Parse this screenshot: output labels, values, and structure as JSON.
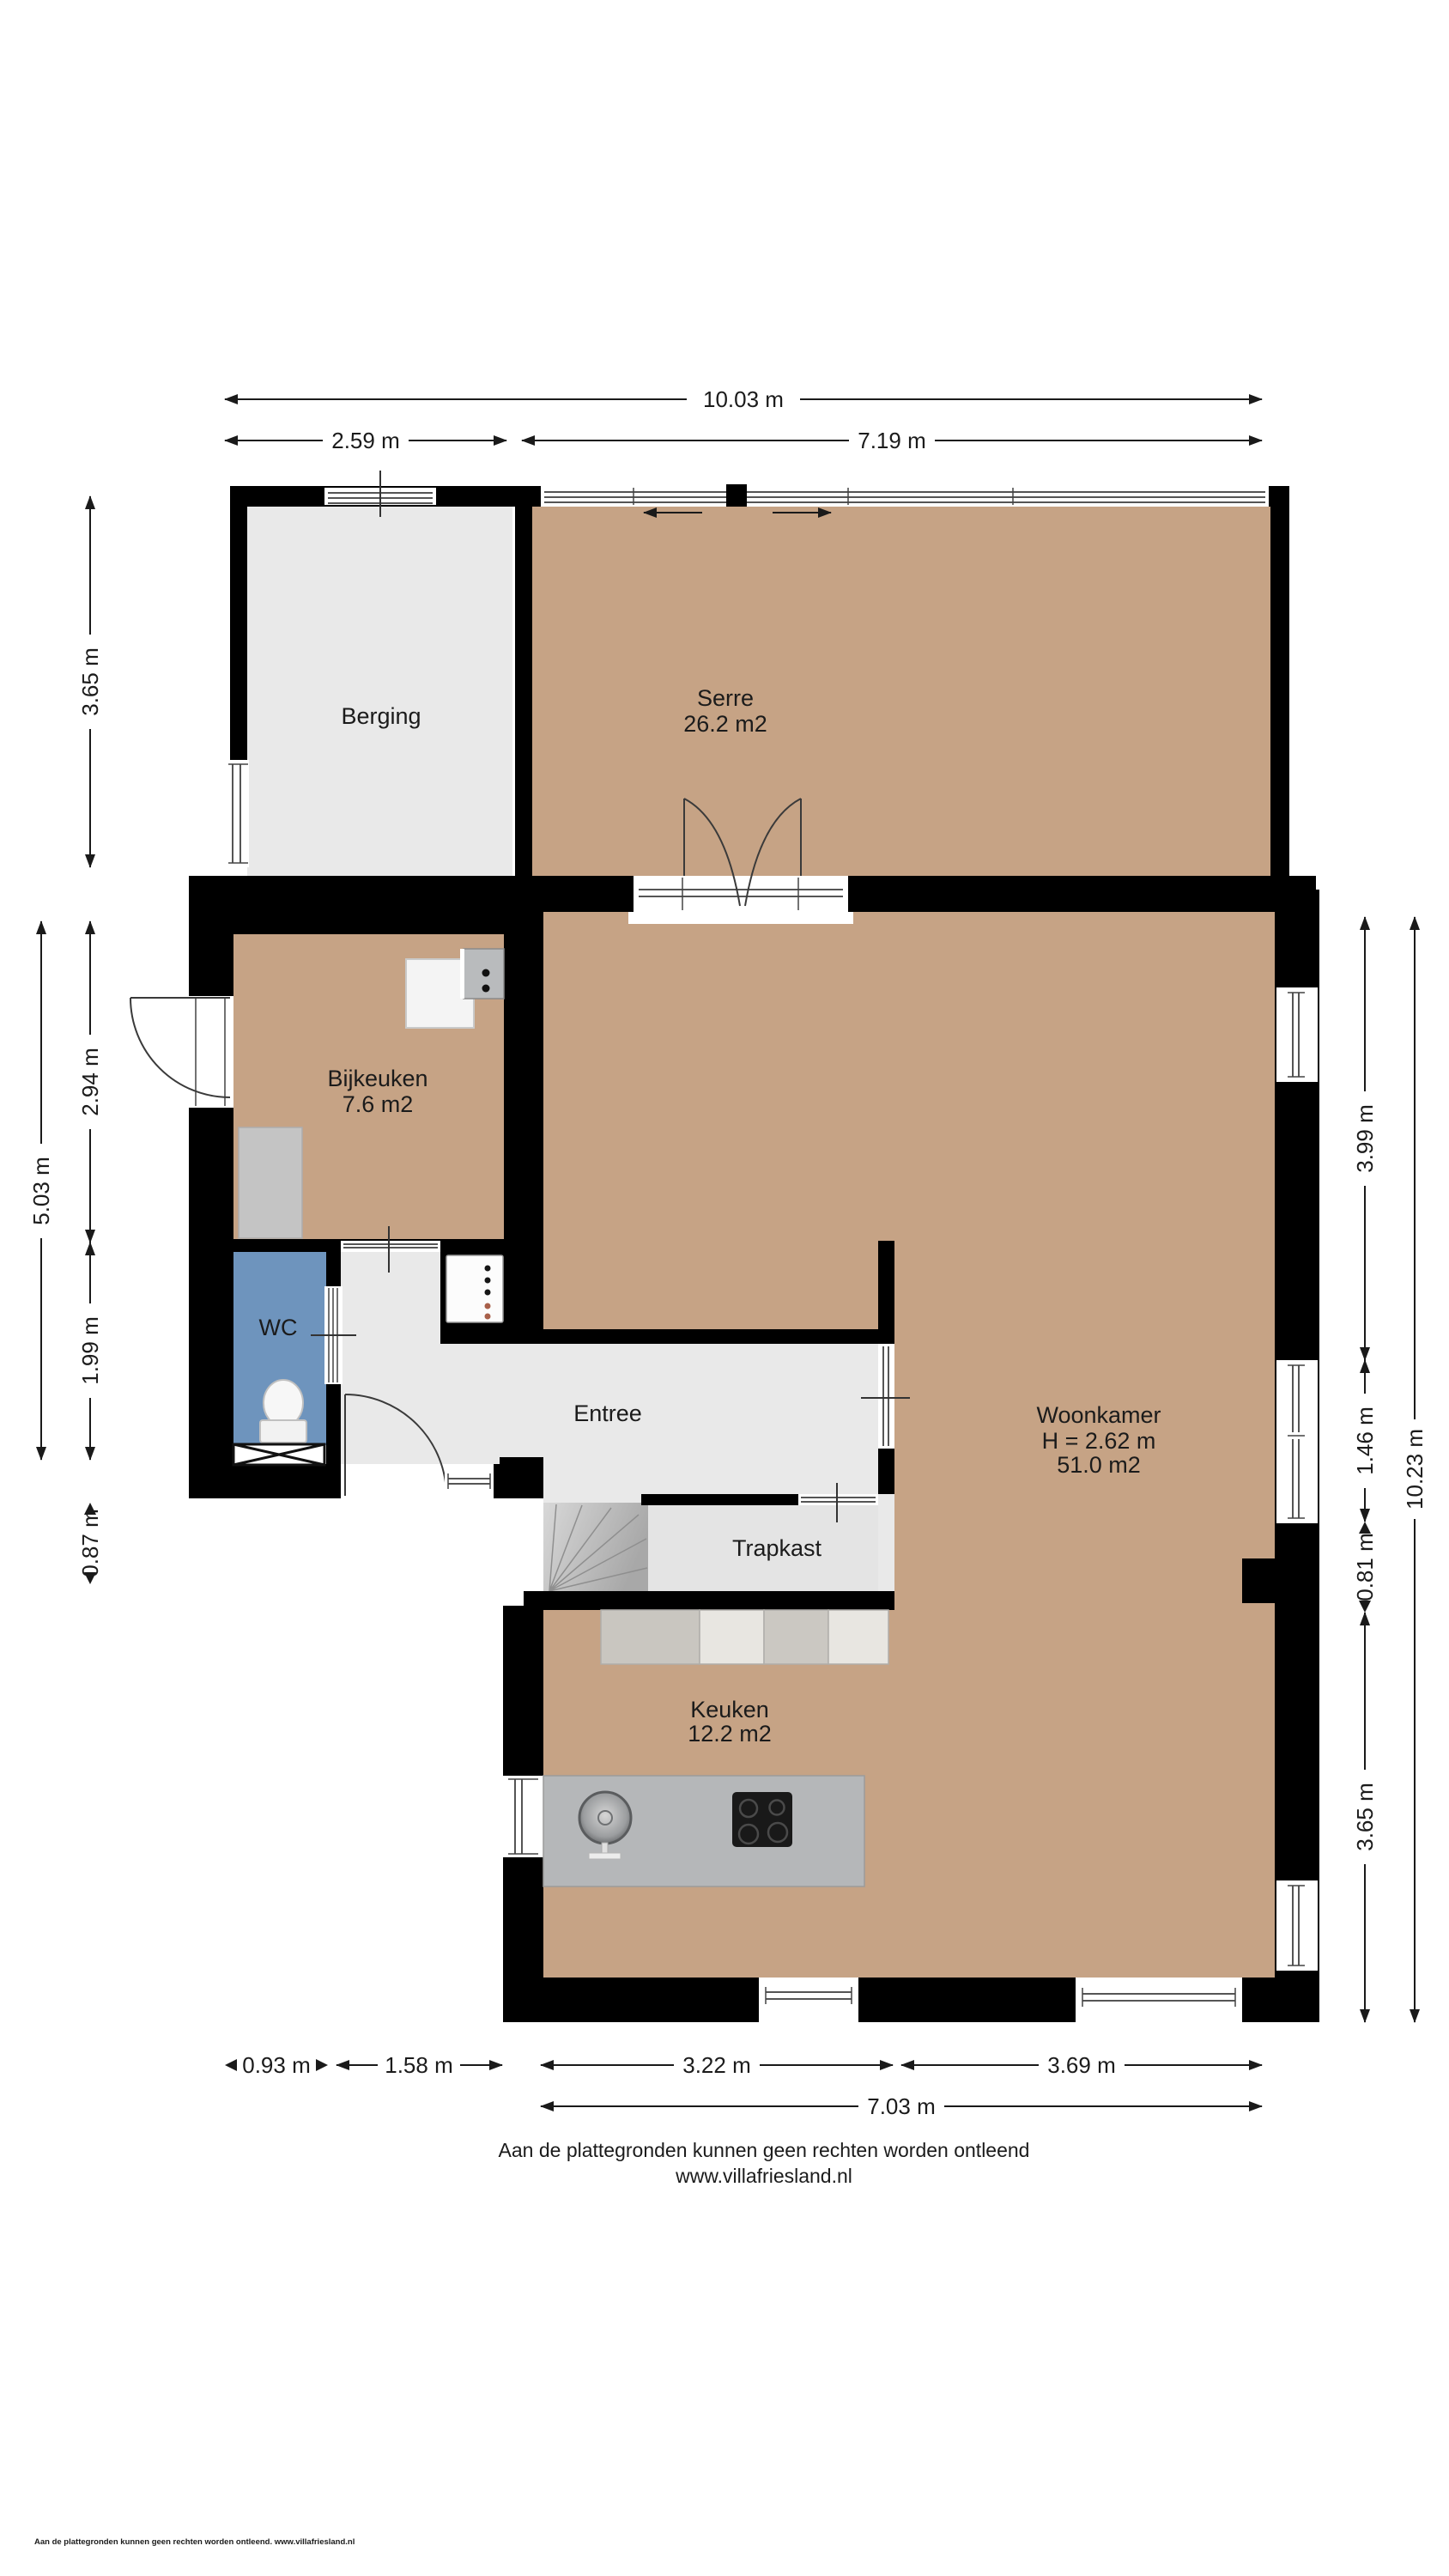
{
  "document": {
    "disclaimer_line1": "Aan de plattegronden kunnen geen rechten worden ontleend",
    "disclaimer_line2": "www.villafriesland.nl",
    "print_footer": "Aan de plattegronden kunnen geen rechten worden ontleend. www.villafriesland.nl"
  },
  "colors": {
    "wall": "#000000",
    "floor_wood": "#c6a385",
    "floor_gray": "#e9e9e9",
    "floor_trapkast": "#e4e4e4",
    "wc_floor": "#6e94bd",
    "counter_gray": "#b5b7b9",
    "cooktop_black": "#191919"
  },
  "rooms": {
    "berging": {
      "name": "Berging"
    },
    "serre": {
      "name": "Serre",
      "area": "26.2 m2"
    },
    "bijkeuken": {
      "name": "Bijkeuken",
      "area": "7.6 m2"
    },
    "wc": {
      "name": "WC"
    },
    "entree": {
      "name": "Entree"
    },
    "trapkast": {
      "name": "Trapkast"
    },
    "keuken": {
      "name": "Keuken",
      "area": "12.2 m2"
    },
    "woonkamer": {
      "name": "Woonkamer",
      "ceiling_height": "H = 2.62 m",
      "area": "51.0 m2"
    }
  },
  "dimensions": {
    "top_total": "10.03 m",
    "top_left": "2.59 m",
    "top_right": "7.19 m",
    "left_berging": "3.65 m",
    "left_bijkeuken": "2.94 m",
    "left_wc": "1.99 m",
    "left_entree": "0.87 m",
    "left_total": "5.03 m",
    "right_woonkamer_top": "3.99 m",
    "right_window": "1.46 m",
    "right_pier": "0.81 m",
    "right_keuken": "3.65 m",
    "right_total": "10.23 m",
    "bottom_wc": "0.93 m",
    "bottom_entree": "1.58 m",
    "bottom_keuken": "3.22 m",
    "bottom_woonkamer": "3.69 m",
    "bottom_total": "7.03 m"
  }
}
